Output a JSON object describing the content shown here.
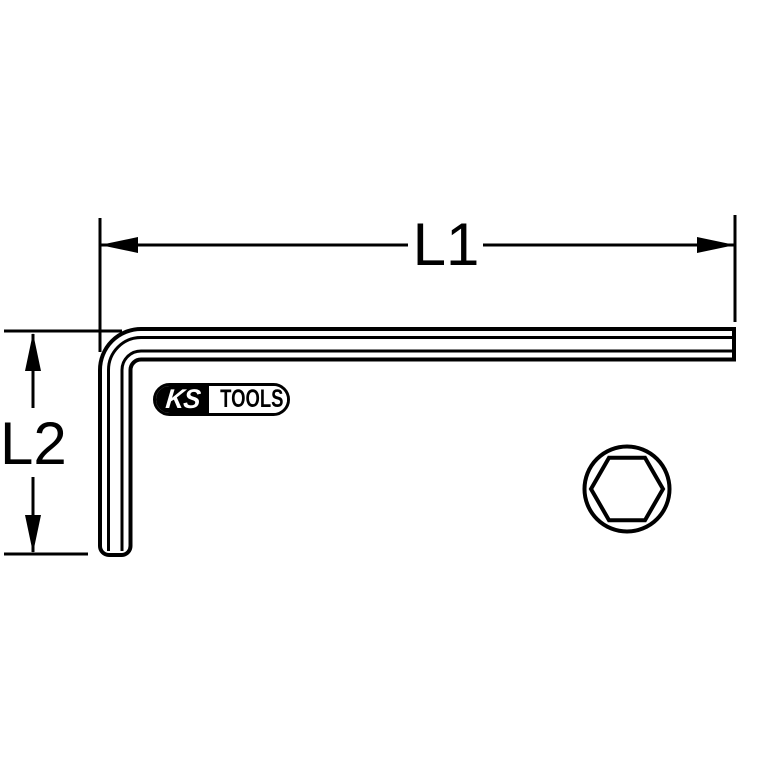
{
  "page": {
    "background_color": "#ffffff",
    "line_color": "#000000"
  },
  "labels": {
    "l1": "L1",
    "l2": "L2"
  },
  "logo": {
    "ks": "KS",
    "tools": "TOOLS",
    "registered": "®"
  },
  "icons": {
    "hex-cross-section": "hexagon-inscribed-in-circle",
    "dimension-arrows": "filled-triangle-arrowheads"
  }
}
